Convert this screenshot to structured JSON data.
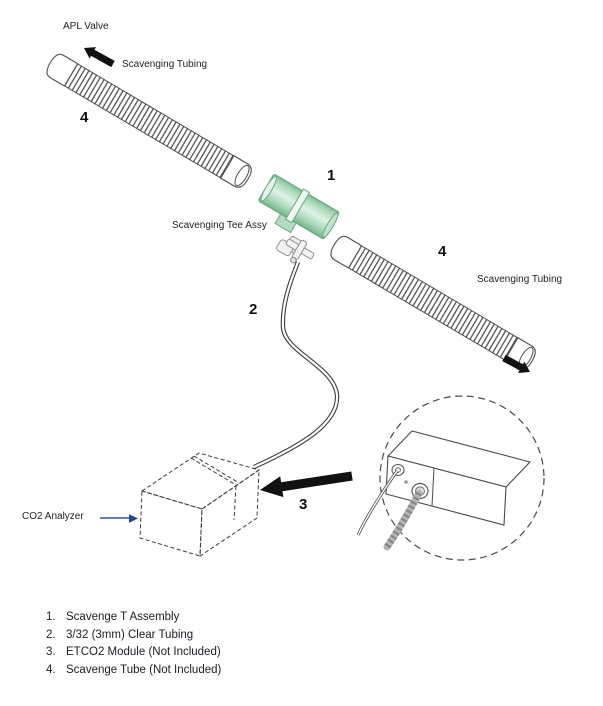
{
  "diagram": {
    "labels": {
      "apl_valve": "APL Valve",
      "scavenging_tubing_left": "Scavenging Tubing",
      "scavenging_tee_assy": "Scavenging Tee Assy",
      "scavenging_tubing_right": "Scavenging Tubing",
      "co2_analyzer": "CO2 Analyzer"
    },
    "callouts": {
      "tee": "1",
      "clear_tubing": "2",
      "etco2_module": "3",
      "scavenge_tube_left": "4",
      "scavenge_tube_right": "4"
    },
    "legend": {
      "items": [
        {
          "num": "1.",
          "text": "Scavenge T Assembly"
        },
        {
          "num": "2.",
          "text": "3/32 (3mm) Clear Tubing"
        },
        {
          "num": "3.",
          "text": "ETCO2 Module (Not Included)"
        },
        {
          "num": "4.",
          "text": "Scavenge Tube (Not Included)"
        }
      ]
    },
    "colors": {
      "tee_green": "#aedcbc",
      "tee_green_edge": "#69a87d",
      "line_art": "#4a4a4a",
      "label_arrow_blue": "#2b57a7",
      "cable_gray": "#b5b5b5",
      "text": "#1f1f1f"
    }
  }
}
